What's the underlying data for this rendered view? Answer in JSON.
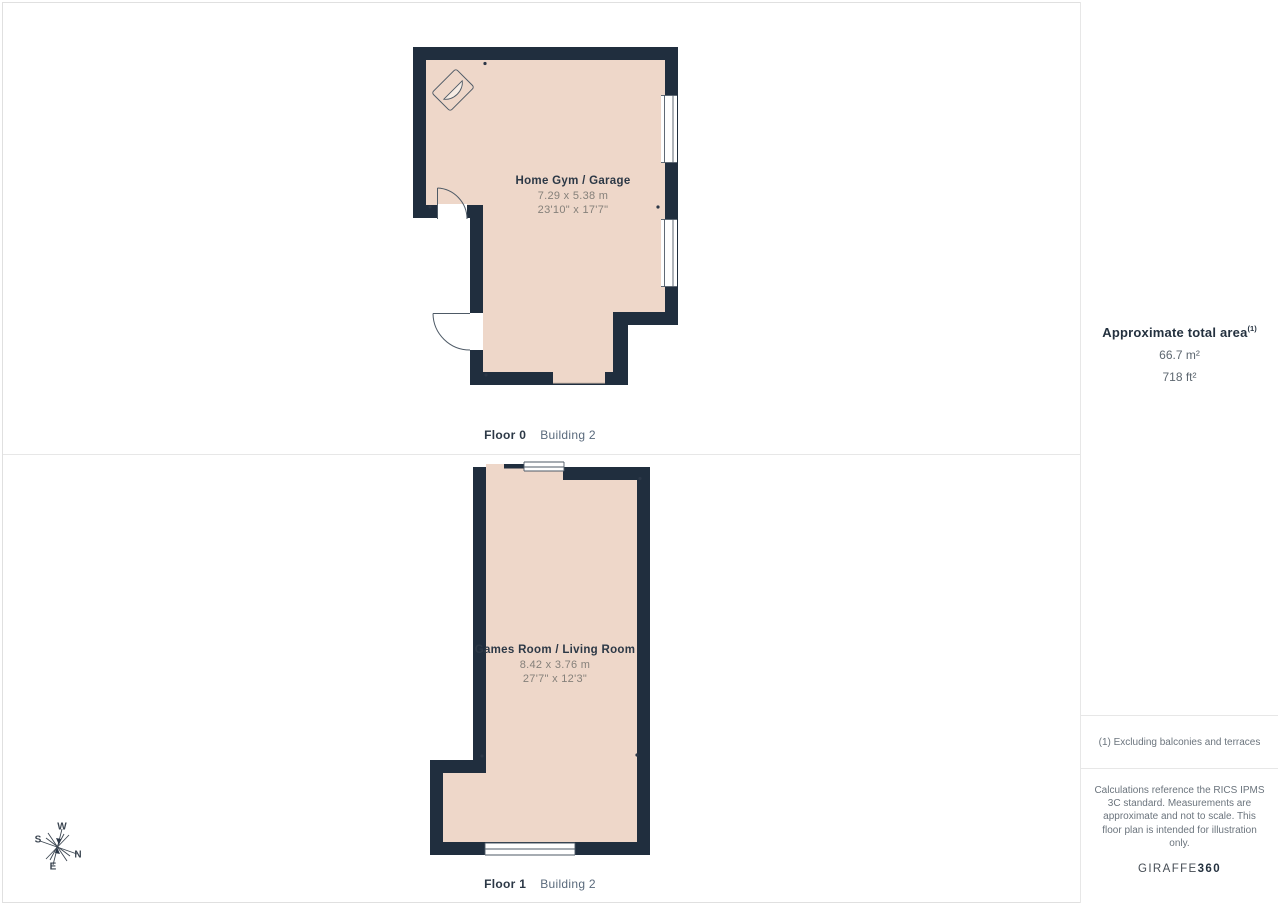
{
  "floors": [
    {
      "name": "Home Gym / Garage",
      "size_metric": "7.29 x 5.38 m",
      "size_imperial": "23'10\" x 17'7\"",
      "floor_label": "Floor 0",
      "building_label": "Building 2"
    },
    {
      "name": "Games Room / Living Room",
      "size_metric": "8.42 x 3.76 m",
      "size_imperial": "27'7\" x 12'3\"",
      "floor_label": "Floor 1",
      "building_label": "Building 2"
    }
  ],
  "sidebar": {
    "title": "Approximate total area",
    "title_sup": "(1)",
    "area_m2": "66.7 m²",
    "area_ft2": "718 ft²",
    "footnote": "(1) Excluding balconies and terraces",
    "disclaimer": "Calculations reference the RICS IPMS 3C standard. Measurements are approximate and not to scale. This floor plan is intended for illustration only.",
    "brand_regular": "GIRAFFE",
    "brand_bold": "360"
  },
  "compass": {
    "north": "N",
    "south": "S",
    "east": "E",
    "west": "W"
  },
  "colors": {
    "wall": "#202e3e",
    "floor": "#eed7c9",
    "line": "#4e5a66",
    "divider": "#e7e7e7"
  }
}
